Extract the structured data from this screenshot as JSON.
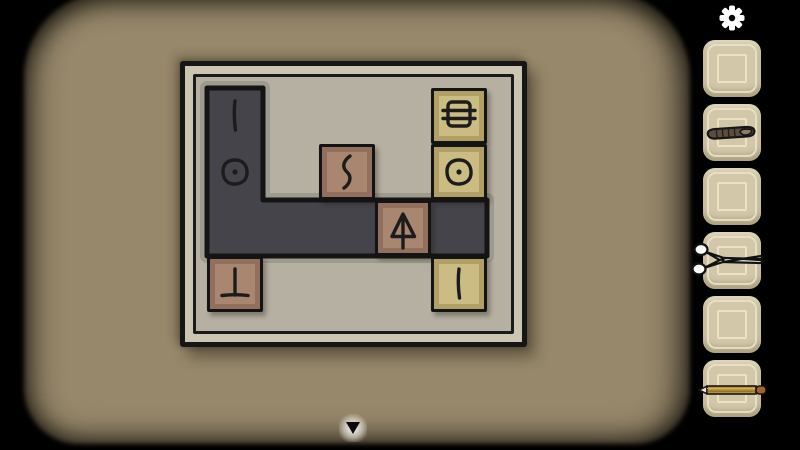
{
  "colors": {
    "page_bg": "#000000",
    "room_bg": "#97886b",
    "board_frame": "#ccc5b1",
    "board_inner": "#b5b0a2",
    "path_fill": "#44444a",
    "path_glow": "#9e9a8d",
    "tile_brown_inner": "#a8866f",
    "tile_brown_ring": "#93705e",
    "tile_khaki_inner": "#cbbc83",
    "tile_khaki_ring": "#b1a066",
    "slot_bg": "#d3c7a9",
    "slot_line": "#ece3c8",
    "gear": "#ffffff"
  },
  "header": {
    "settings_icon": "gear-icon"
  },
  "board": {
    "grid": {
      "cols": 5,
      "rows": 4,
      "cell_px": 56
    },
    "path_cells": [
      [
        1,
        1
      ],
      [
        1,
        2
      ],
      [
        1,
        3
      ],
      [
        2,
        3
      ],
      [
        3,
        3
      ],
      [
        4,
        3
      ],
      [
        5,
        3
      ]
    ],
    "path_symbols": [
      {
        "col": 1,
        "row": 1,
        "symbol": "vertical-line"
      },
      {
        "col": 1,
        "row": 2,
        "symbol": "circle-dot"
      }
    ],
    "tiles": [
      {
        "col": 3,
        "row": 2,
        "style": "brown",
        "symbol": "squiggle"
      },
      {
        "col": 4,
        "row": 3,
        "style": "brown",
        "symbol": "arrow-up"
      },
      {
        "col": 1,
        "row": 4,
        "style": "brown",
        "symbol": "inverted-t"
      },
      {
        "col": 5,
        "row": 1,
        "style": "khaki",
        "symbol": "barred-square"
      },
      {
        "col": 5,
        "row": 2,
        "style": "khaki",
        "symbol": "circle-dot"
      },
      {
        "col": 5,
        "row": 4,
        "style": "khaki",
        "symbol": "vertical-line"
      }
    ]
  },
  "inventory": {
    "slots": [
      {
        "item": null
      },
      {
        "item": "cigar"
      },
      {
        "item": null
      },
      {
        "item": "scissors"
      },
      {
        "item": null
      },
      {
        "item": "pencil"
      }
    ]
  },
  "footer": {
    "nav_icon": "down-arrow"
  }
}
